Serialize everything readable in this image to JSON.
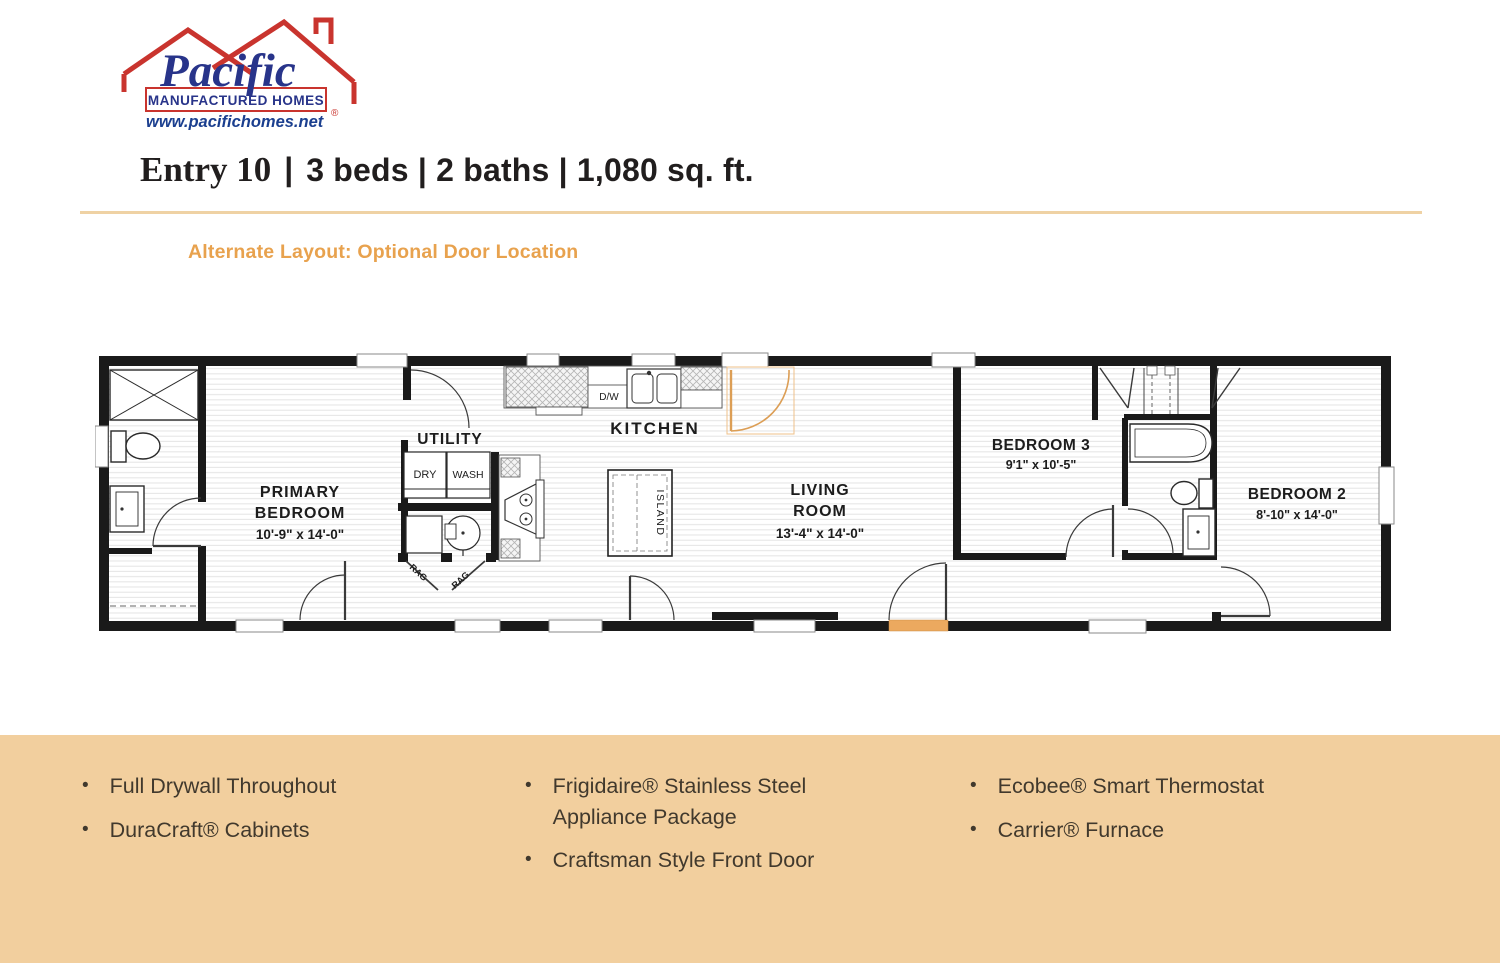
{
  "page": {
    "band_bg": "#F2CF9E",
    "divider_color": "#EFD2A4",
    "accent_orange": "#ECA95F"
  },
  "logo": {
    "brand": "Pacific",
    "sub_line": "MANUFACTURED HOMES",
    "registered": "®",
    "url": "www.pacifichomes.net",
    "red": "#C9342E",
    "blue": "#28348A"
  },
  "header": {
    "model": "Entry 10",
    "separator": "|",
    "specs": "3 beds | 2 baths | 1,080 sq. ft."
  },
  "subtitle": "Alternate Layout: Optional Door Location",
  "floorplan": {
    "rooms": {
      "primary": {
        "line1": "PRIMARY",
        "line2": "BEDROOM",
        "dims": "10'-9\" x 14'-0\""
      },
      "utility": {
        "label": "UTILITY"
      },
      "kitchen": {
        "label": "KITCHEN"
      },
      "living": {
        "line1": "LIVING",
        "line2": "ROOM",
        "dims": "13'-4\" x 14'-0\""
      },
      "bedroom3": {
        "label": "BEDROOM 3",
        "dims": "9'1\" x 10'-5\""
      },
      "bedroom2": {
        "label": "BEDROOM 2",
        "dims": "8'-10\" x 14'-0\""
      }
    },
    "fixtures": {
      "dryer": "DRY",
      "washer": "WASH",
      "dishwasher": "D/W",
      "island": "ISLAND",
      "rag_left": "RAG",
      "rag_right": "RAG"
    }
  },
  "features": {
    "bullet": "•",
    "columns": [
      {
        "items": [
          "Full Drywall Throughout",
          "DuraCraft® Cabinets"
        ]
      },
      {
        "items": [
          "Frigidaire® Stainless Steel Appliance Package",
          "Craftsman Style Front Door"
        ]
      },
      {
        "items": [
          "Ecobee® Smart Thermostat",
          "Carrier® Furnace"
        ]
      }
    ]
  }
}
